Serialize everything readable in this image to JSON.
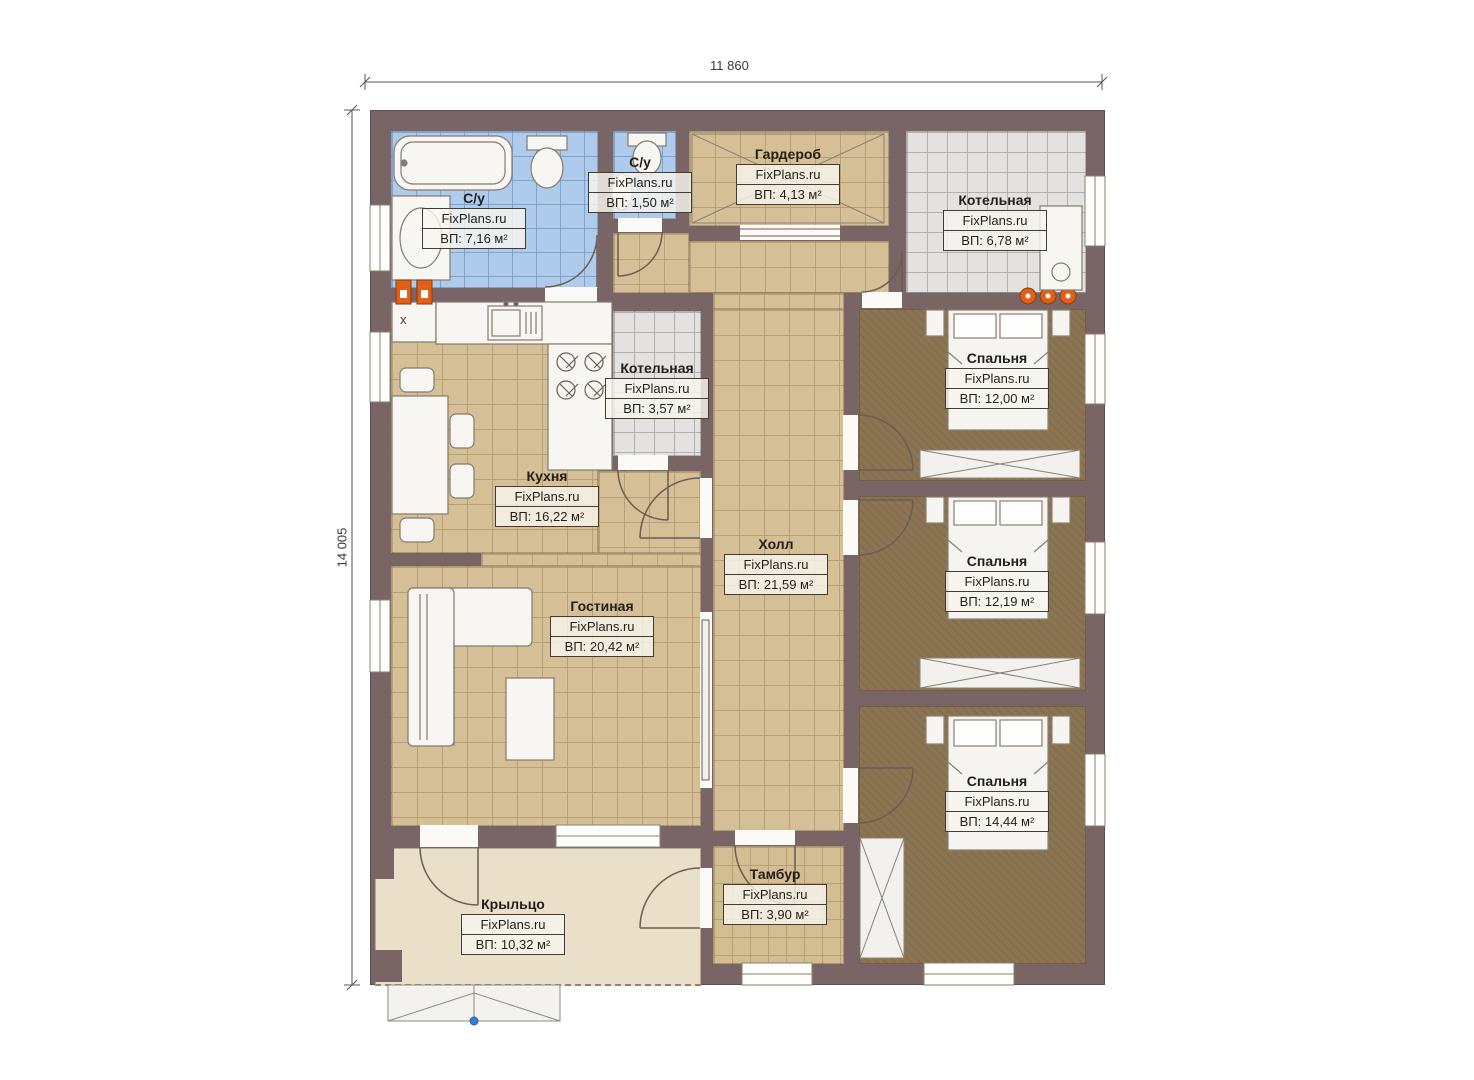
{
  "dimensions": {
    "width_label": "11 860",
    "height_label": "14 005"
  },
  "watermark": "FixPlans.ru",
  "appliance_marker": "x",
  "rooms": [
    {
      "id": "bathroom-main",
      "name": "С/у",
      "area": "ВП: 7,16 м²"
    },
    {
      "id": "bathroom-small",
      "name": "С/у",
      "area": "ВП: 1,50 м²"
    },
    {
      "id": "wardrobe",
      "name": "Гардероб",
      "area": "ВП: 4,13 м²"
    },
    {
      "id": "boiler-top",
      "name": "Котельная",
      "area": "ВП: 6,78 м²"
    },
    {
      "id": "boiler-mid",
      "name": "Котельная",
      "area": "ВП: 3,57 м²"
    },
    {
      "id": "kitchen",
      "name": "Кухня",
      "area": "ВП: 16,22 м²"
    },
    {
      "id": "hall",
      "name": "Холл",
      "area": "ВП: 21,59 м²"
    },
    {
      "id": "living",
      "name": "Гостиная",
      "area": "ВП: 20,42 м²"
    },
    {
      "id": "bedroom-1",
      "name": "Спальня",
      "area": "ВП: 12,00 м²"
    },
    {
      "id": "bedroom-2",
      "name": "Спальня",
      "area": "ВП: 12,19 м²"
    },
    {
      "id": "bedroom-3",
      "name": "Спальня",
      "area": "ВП: 14,44 м²"
    },
    {
      "id": "tambour",
      "name": "Тамбур",
      "area": "ВП: 3,90 м²"
    },
    {
      "id": "porch",
      "name": "Крыльцо",
      "area": "ВП: 10,32 м²"
    }
  ],
  "colors": {
    "wall": "#7a6566",
    "tile_blue": "#aecbec",
    "tile_tan": "#d5bf96",
    "tile_grey": "#e3e2e0",
    "floor_brown": "#8b7452",
    "porch": "#eadfc9",
    "accent_orange": "#e06018",
    "label_ink": "#241e19"
  }
}
